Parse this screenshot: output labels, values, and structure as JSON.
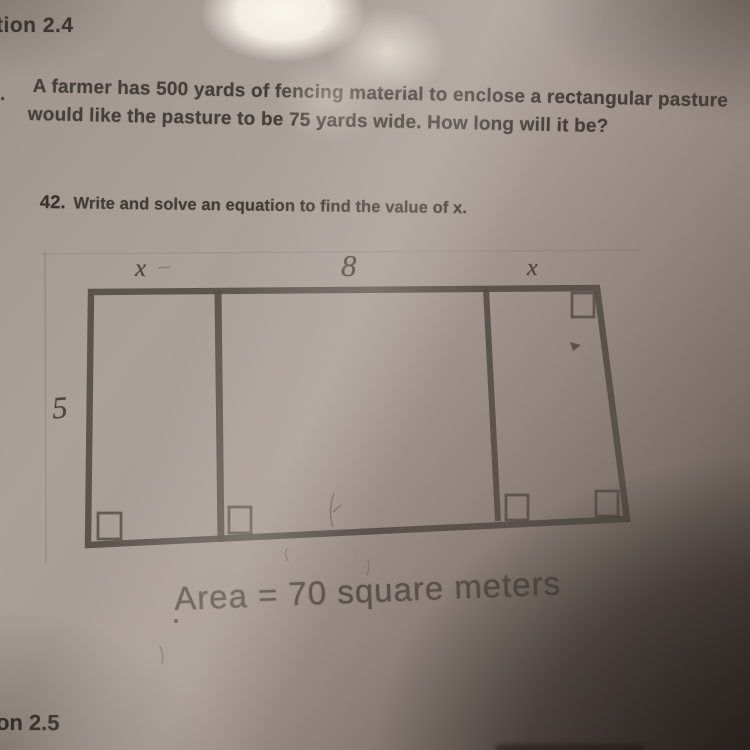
{
  "page": {
    "header_top": "tion 2.4",
    "problem41_marker": ".",
    "problem41_line1": "A farmer has 500 yards of fencing material to enclose a rectangular pasture",
    "problem41_line2": "would like the pasture to be 75 yards wide.  How long will it be?",
    "problem42_number": "42.",
    "problem42_prompt": "Write and solve an equation to find the value of x.",
    "header_bottom": "on 2.5"
  },
  "diagram": {
    "label_top_left": "x",
    "label_top_middle": "8",
    "label_top_right": "x",
    "label_left_height": "5",
    "caption": "Area = 70 square meters",
    "line_color": "#564d47"
  }
}
